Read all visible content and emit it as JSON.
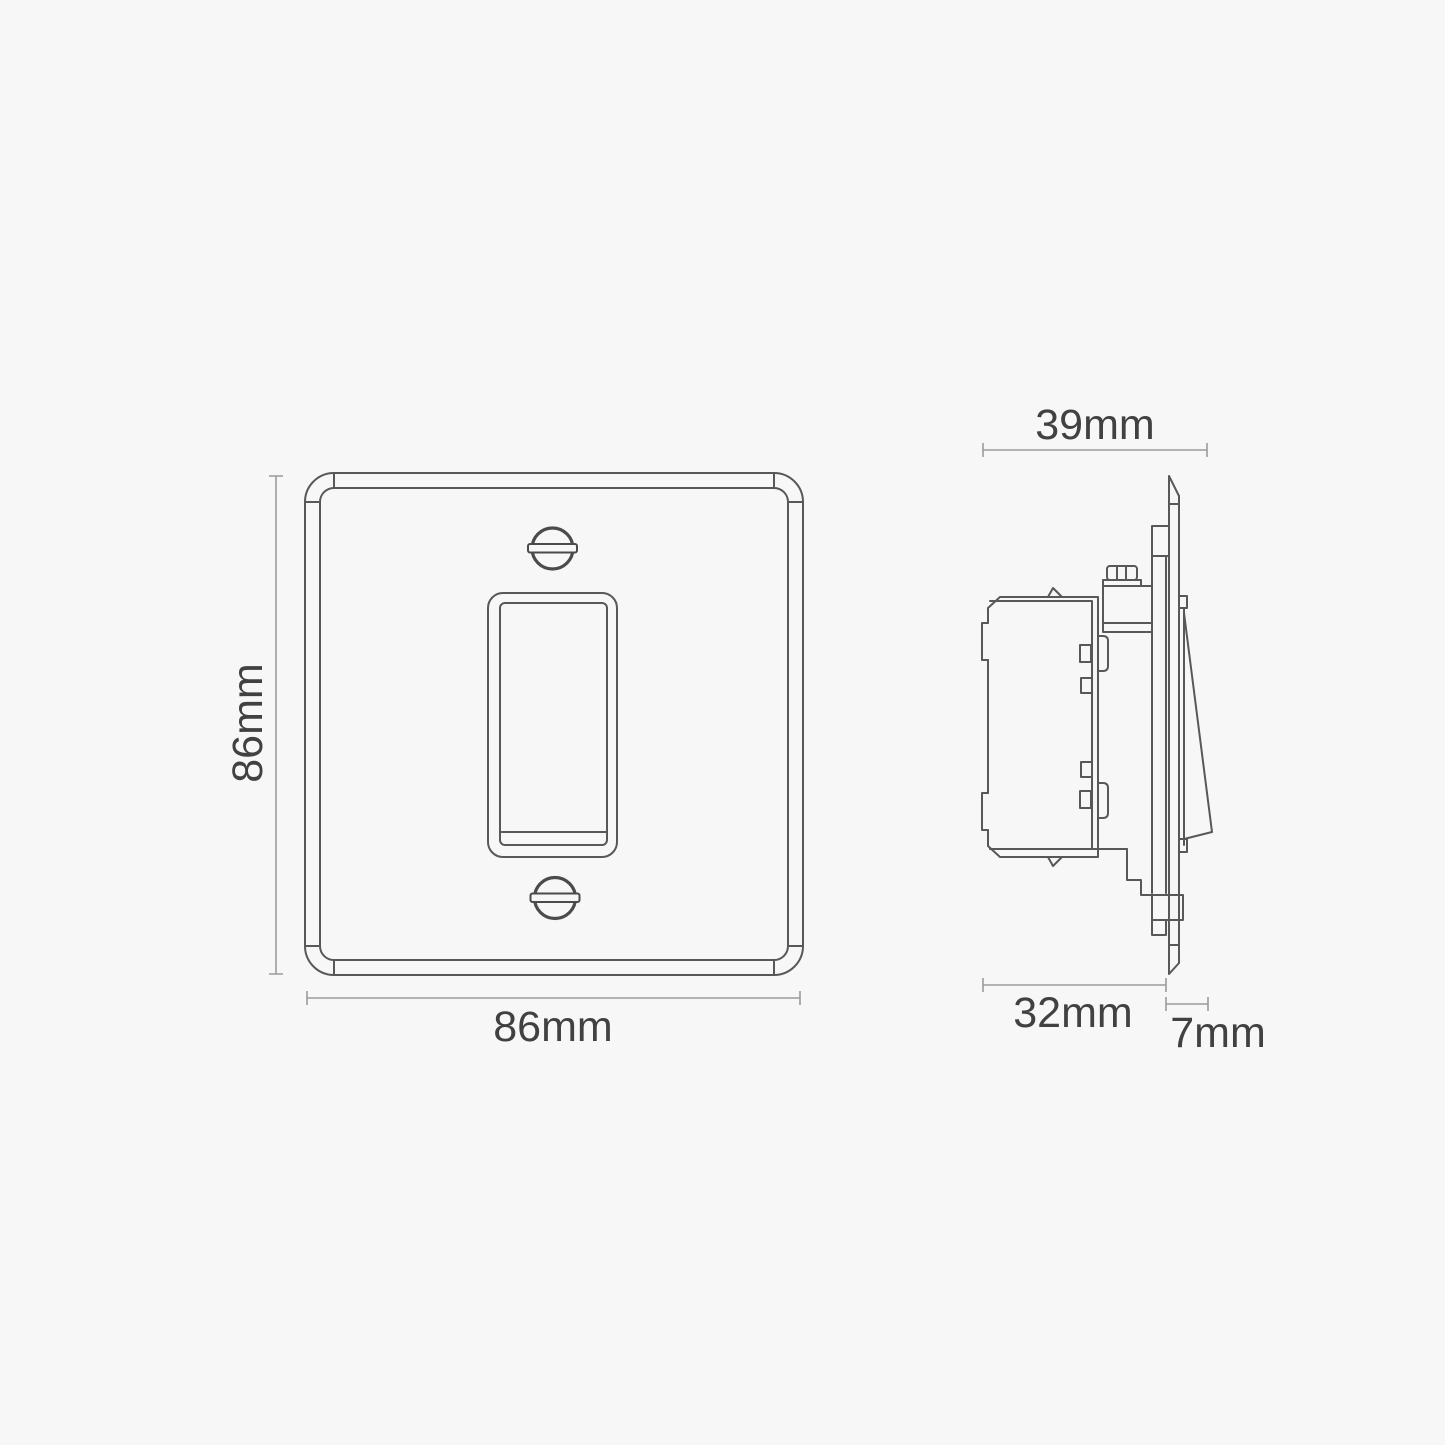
{
  "front_view": {
    "height_label": "86mm",
    "width_label": "86mm"
  },
  "side_view": {
    "depth_label": "39mm",
    "module_depth_label": "32mm",
    "faceplate_thickness_label": "7mm"
  },
  "colors": {
    "background": "#f7f7f7",
    "line": "#57585a",
    "dimension_line": "#9b9b9b",
    "text": "#414042"
  }
}
